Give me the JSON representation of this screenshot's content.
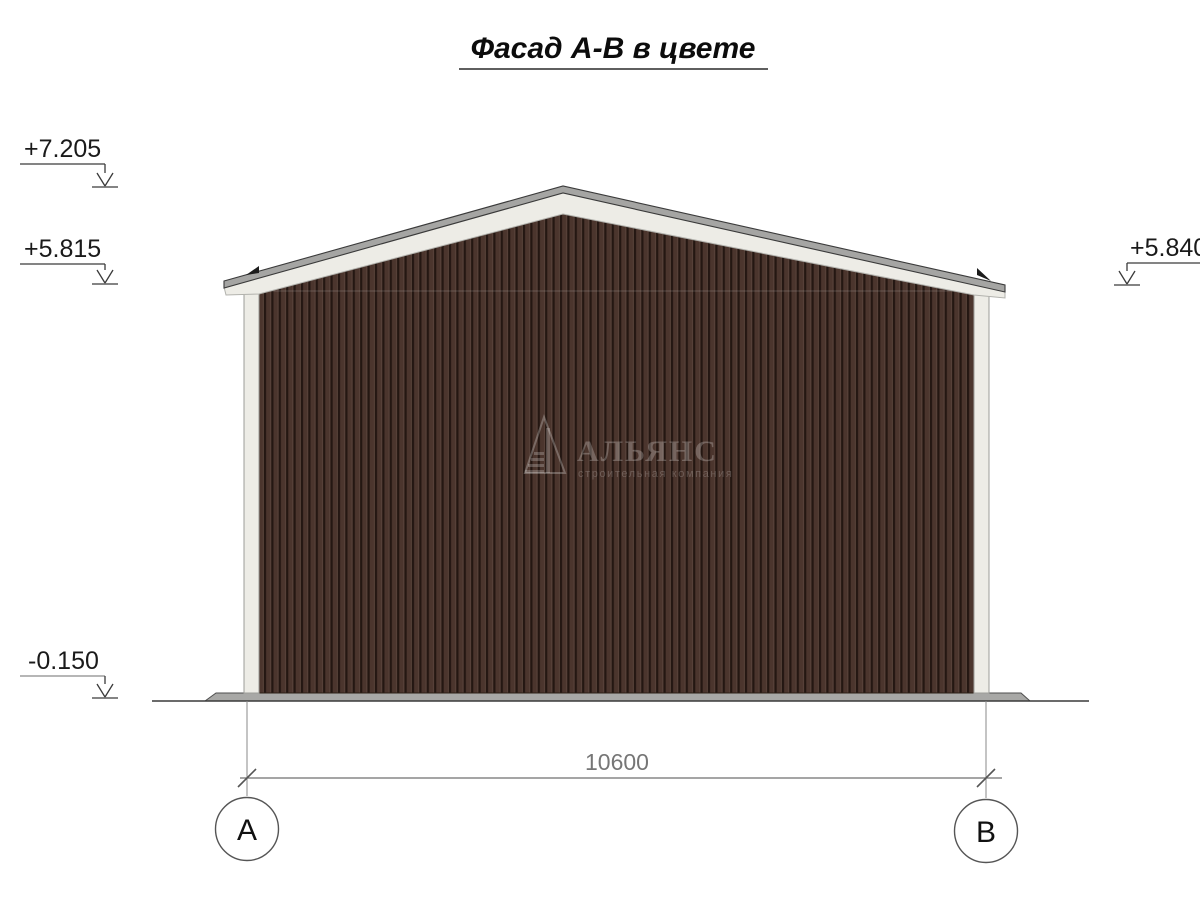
{
  "title": "Фасад А-В в цвете",
  "elevations": {
    "ridge": "+7.205",
    "eave_left": "+5.815",
    "eave_right": "+5.840",
    "ground": "-0.150"
  },
  "dimension": {
    "overall": "10600"
  },
  "axes": {
    "left": "А",
    "right": "В"
  },
  "watermark": {
    "company": "АЛЬЯНС",
    "tagline": "строительная компания"
  },
  "colors": {
    "siding_base": "#4b352d",
    "siding_groove": "#241712",
    "siding_highlight": "#5f4940",
    "trim_white": "#edece6",
    "roof_cap_gray": "#a5a5a3",
    "plinth_gray": "#a8a8a6",
    "line_dark": "#3a3a3a",
    "dim_gray": "#6f6f6f"
  }
}
